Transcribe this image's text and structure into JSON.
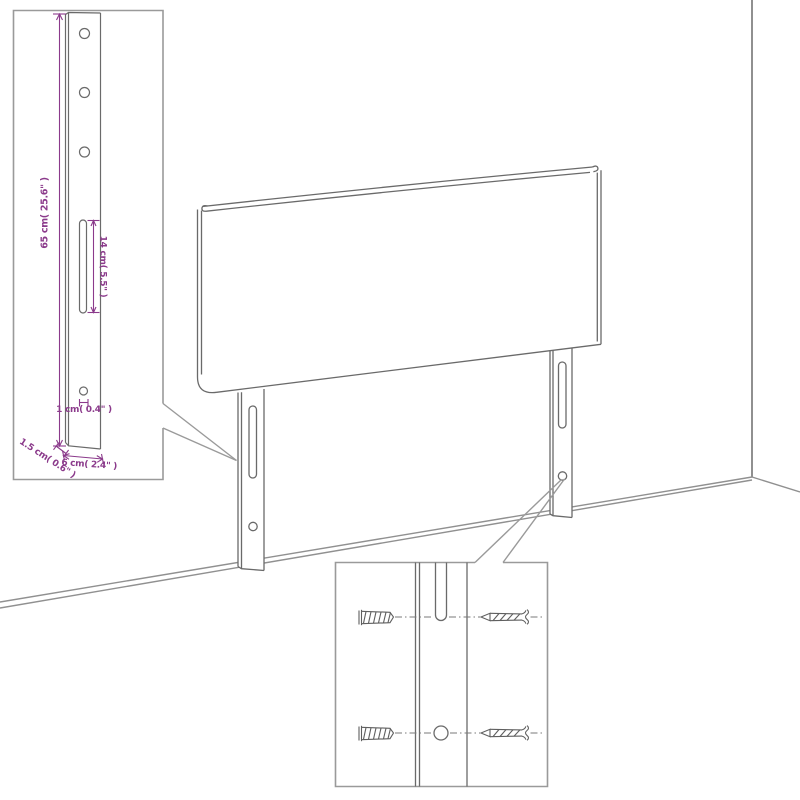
{
  "colors": {
    "accent_purple": "#8B3A8B",
    "drawing_gray": "#6a6a6a",
    "inset_border_gray": "#9a9a9a",
    "wall_gray": "#909090",
    "dash_gray": "#7a7a7a"
  },
  "leg_dimension_inset": {
    "labels": {
      "leg_height": "65 cm( 25.6\" )",
      "slot_length": "14 cm( 5.5\" )",
      "hole_diameter": "1 cm( 0.4\" )",
      "leg_thickness": "1.5 cm( 0.6\" )",
      "leg_width": "6 cm( 2.4\" )"
    }
  },
  "mounting_detail_inset": {
    "hardware": [
      "wall-plug",
      "screw"
    ]
  }
}
